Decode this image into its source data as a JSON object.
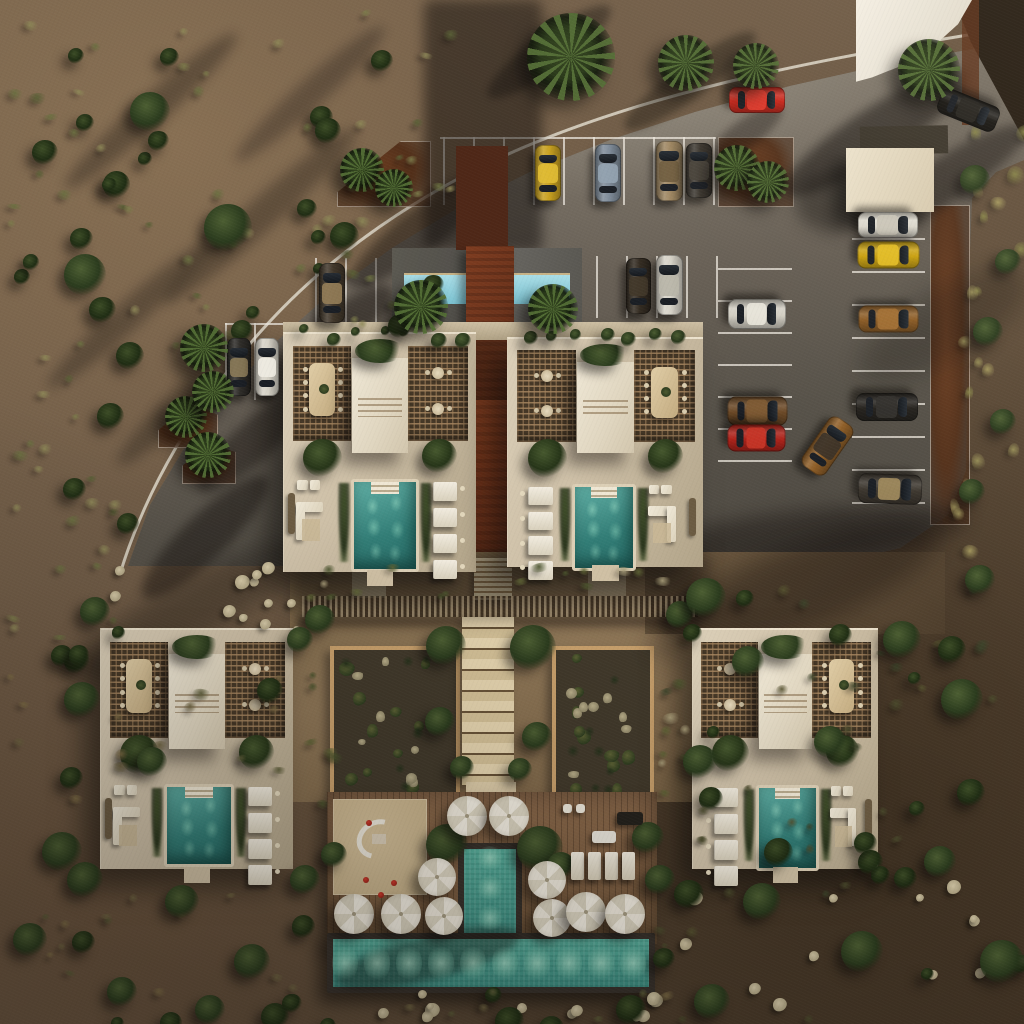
{
  "meta": {
    "type": "architectural-aerial-render",
    "description": "Top-down 3D architectural rendering of a desert resort complex: four villa units with rooftop pergolas and private teal pools, two central courtyard garden plots, a T-shaped public pool with white umbrellas and wood deck, a lap pool with rust walkway, and a curved gray parking lot with parked cars surrounded by scrub desert."
  },
  "palette": {
    "desert": "#6a5845",
    "desert_dark": "#4c3c2b",
    "road": "#7e766a",
    "road_shadow": "#4b463f",
    "building": "#cdbfa6",
    "roof_volume": "#efe7d5",
    "lattice": "#453726",
    "pool_private": "#327d76",
    "pool_main": "#3b8c80",
    "pool_lap": "#7cc3d2",
    "rust_walkway": "#6e3219",
    "wood_deck": "#7a5c40",
    "sand": "#cfbb95",
    "umbrella": "#f2ede1",
    "garden_soil": "#40382a",
    "garden_frame": "#c79f6b",
    "stairs": "#d9c7a4"
  },
  "curb_path": "M 120 574 C 146 488 196 404 262 330 C 330 254 420 192 522 148 C 640 98 780 64 1012 28",
  "stall_groups": [
    {
      "dir": "v",
      "xs": [
        443,
        473,
        503,
        533,
        563,
        593,
        623,
        653,
        683,
        713
      ],
      "y1": 137,
      "y2": 205
    },
    {
      "dir": "h",
      "ys": [
        137
      ],
      "x1": 440,
      "x2": 716
    },
    {
      "dir": "v",
      "xs": [
        315,
        345,
        375,
        405
      ],
      "y1": 258,
      "y2": 330
    },
    {
      "dir": "v",
      "xs": [
        596,
        626,
        656,
        686,
        716
      ],
      "y1": 256,
      "y2": 318
    },
    {
      "dir": "v",
      "xs": [
        225,
        254,
        283
      ],
      "y1": 323,
      "y2": 400
    },
    {
      "dir": "h",
      "ys": [
        323
      ],
      "x1": 225,
      "x2": 283
    },
    {
      "dir": "h",
      "ys": [
        268,
        300,
        332,
        364,
        396,
        428,
        460
      ],
      "x1": 718,
      "x2": 792
    },
    {
      "dir": "h",
      "ys": [
        205,
        238,
        271,
        304,
        337,
        370,
        403,
        436,
        469,
        502
      ],
      "x1": 852,
      "x2": 925
    }
  ],
  "planters": [
    {
      "x": 337,
      "y": 141,
      "w": 92,
      "h": 64,
      "clip": "polygon(0 78%, 68% 0, 100% 0, 100% 100%, 0 100%)"
    },
    {
      "x": 718,
      "y": 137,
      "w": 74,
      "h": 68,
      "clip": ""
    },
    {
      "x": 158,
      "y": 402,
      "w": 58,
      "h": 44,
      "clip": "polygon(0 62%, 55% 0, 100% 28%, 100% 100%, 0 100%)"
    },
    {
      "x": 182,
      "y": 444,
      "w": 52,
      "h": 38,
      "clip": "polygon(0 55%, 50% 0, 100% 20%, 100% 100%, 0 100%)"
    },
    {
      "x": 930,
      "y": 205,
      "w": 38,
      "h": 318,
      "clip": ""
    }
  ],
  "shadow_streaks": [
    {
      "x": 424,
      "y": 0,
      "w": 118,
      "h": 252,
      "rot": 0,
      "op": 0.5,
      "bl": 6,
      "shape": "rect",
      "layer": "road"
    },
    {
      "x": 766,
      "y": 108,
      "w": 220,
      "h": 50,
      "rot": -33,
      "op": 0.5,
      "bl": 5,
      "shape": "ell",
      "layer": "road"
    },
    {
      "x": 842,
      "y": 160,
      "w": 200,
      "h": 44,
      "rot": -33,
      "op": 0.45,
      "bl": 5,
      "shape": "ell",
      "layer": "road"
    },
    {
      "x": 474,
      "y": 34,
      "w": 150,
      "h": 36,
      "rot": -36,
      "op": 0.4,
      "bl": 4,
      "shape": "ell",
      "layer": "road"
    },
    {
      "x": 610,
      "y": 64,
      "w": 160,
      "h": 34,
      "rot": -36,
      "op": 0.38,
      "bl": 4,
      "shape": "ell",
      "layer": "road"
    },
    {
      "x": 700,
      "y": 120,
      "w": 90,
      "h": 28,
      "rot": -36,
      "op": 0.35,
      "bl": 4,
      "shape": "ell",
      "layer": "road"
    },
    {
      "x": 330,
      "y": 205,
      "w": 190,
      "h": 44,
      "rot": -38,
      "op": 0.45,
      "bl": 5,
      "shape": "ell",
      "layer": "road"
    },
    {
      "x": 240,
      "y": 320,
      "w": 170,
      "h": 44,
      "rot": -40,
      "op": 0.45,
      "bl": 5,
      "shape": "ell",
      "layer": "road"
    },
    {
      "x": 180,
      "y": 420,
      "w": 150,
      "h": 40,
      "rot": -42,
      "op": 0.42,
      "bl": 5,
      "shape": "ell",
      "layer": "road"
    },
    {
      "x": 120,
      "y": 515,
      "w": 170,
      "h": 44,
      "rot": -44,
      "op": 0.45,
      "bl": 5,
      "shape": "ell",
      "layer": "road"
    },
    {
      "x": 795,
      "y": 172,
      "w": 80,
      "h": 60,
      "rot": 0,
      "op": 0.4,
      "bl": 8,
      "shape": "ell",
      "layer": "road"
    },
    {
      "x": 640,
      "y": 510,
      "w": 330,
      "h": 52,
      "rot": -6,
      "op": 0.42,
      "bl": 9,
      "shape": "ell",
      "layer": "road"
    },
    {
      "x": 848,
      "y": 290,
      "w": 190,
      "h": 70,
      "rot": -30,
      "op": 0.26,
      "bl": 12,
      "shape": "ell",
      "layer": "road"
    },
    {
      "x": 36,
      "y": 96,
      "w": 230,
      "h": 30,
      "rot": -42,
      "op": 0.32,
      "bl": 6,
      "shape": "ell",
      "layer": "back"
    },
    {
      "x": 130,
      "y": 200,
      "w": 260,
      "h": 32,
      "rot": -42,
      "op": 0.3,
      "bl": 6,
      "shape": "ell",
      "layer": "back"
    },
    {
      "x": 20,
      "y": 300,
      "w": 220,
      "h": 28,
      "rot": -42,
      "op": 0.3,
      "bl": 6,
      "shape": "ell",
      "layer": "back"
    },
    {
      "x": 210,
      "y": 80,
      "w": 200,
      "h": 28,
      "rot": -42,
      "op": 0.28,
      "bl": 6,
      "shape": "ell",
      "layer": "back"
    },
    {
      "x": 90,
      "y": 380,
      "w": 200,
      "h": 30,
      "rot": -44,
      "op": 0.3,
      "bl": 6,
      "shape": "ell",
      "layer": "back"
    },
    {
      "x": 292,
      "y": 552,
      "w": 418,
      "h": 66,
      "rot": 0,
      "op": 0.42,
      "bl": 9,
      "shape": "rect",
      "layer": "mid"
    },
    {
      "x": 640,
      "y": 548,
      "w": 310,
      "h": 84,
      "rot": -22,
      "op": 0.36,
      "bl": 12,
      "shape": "ell",
      "layer": "mid"
    },
    {
      "x": 60,
      "y": 580,
      "w": 260,
      "h": 60,
      "rot": -30,
      "op": 0.3,
      "bl": 10,
      "shape": "ell",
      "layer": "mid"
    }
  ],
  "cars": [
    {
      "c": [
        757,
        100
      ],
      "w": 26,
      "l": 56,
      "rot": 90,
      "color": "#c8251a",
      "roof": "#e0392c"
    },
    {
      "c": [
        548,
        173
      ],
      "w": 26,
      "l": 56,
      "rot": 0,
      "color": "#c9a11f",
      "roof": "#e0bc33"
    },
    {
      "c": [
        608,
        173
      ],
      "w": 26,
      "l": 58,
      "rot": 0,
      "color": "#7e8b99",
      "roof": "#93a2b0"
    },
    {
      "c": [
        669,
        171
      ],
      "w": 27,
      "l": 60,
      "rot": 0,
      "color": "#9d8560",
      "roof": "#6e5b3e"
    },
    {
      "c": [
        699,
        170
      ],
      "w": 26,
      "l": 55,
      "rot": 0,
      "color": "#3a352e",
      "roof": "#4a443c"
    },
    {
      "c": [
        332,
        293
      ],
      "w": 26,
      "l": 60,
      "rot": 0,
      "color": "#41372a",
      "roof": "#937c57"
    },
    {
      "c": [
        638,
        286
      ],
      "w": 25,
      "l": 56,
      "rot": 0,
      "color": "#332b21",
      "roof": "#413729"
    },
    {
      "c": [
        669,
        285
      ],
      "w": 27,
      "l": 60,
      "rot": 0,
      "color": "#d7d3c8",
      "roof": "#b9b5a8"
    },
    {
      "c": [
        239,
        367
      ],
      "w": 24,
      "l": 58,
      "rot": 0,
      "color": "#2e2c28",
      "roof": "#8a7a58"
    },
    {
      "c": [
        267,
        367
      ],
      "w": 24,
      "l": 58,
      "rot": 0,
      "color": "#d6d2c6",
      "roof": "#efece2"
    },
    {
      "c": [
        757,
        314
      ],
      "w": 30,
      "l": 58,
      "rot": 90,
      "color": "#d2cec3",
      "roof": "#e8e5da"
    },
    {
      "c": [
        757,
        411
      ],
      "w": 29,
      "l": 60,
      "rot": 90,
      "color": "#6a4826",
      "roof": "#7e5a33"
    },
    {
      "c": [
        756,
        438
      ],
      "w": 27,
      "l": 58,
      "rot": 90,
      "color": "#ad231a",
      "roof": "#c53527"
    },
    {
      "c": [
        827,
        446
      ],
      "w": 29,
      "l": 60,
      "rot": 35,
      "color": "#8f5e27",
      "roof": "#3a3127"
    },
    {
      "c": [
        888,
        225
      ],
      "w": 26,
      "l": 60,
      "rot": 90,
      "color": "#dcd8cd",
      "roof": "#c9c4b7"
    },
    {
      "c": [
        888,
        255
      ],
      "w": 27,
      "l": 62,
      "rot": 90,
      "color": "#c9a00e",
      "roof": "#e3bd25"
    },
    {
      "c": [
        888,
        319
      ],
      "w": 27,
      "l": 60,
      "rot": 90,
      "color": "#8a5a24",
      "roof": "#a26f33"
    },
    {
      "c": [
        887,
        407
      ],
      "w": 28,
      "l": 62,
      "rot": 90,
      "color": "#24211d",
      "roof": "#32302c"
    },
    {
      "c": [
        890,
        489
      ],
      "w": 30,
      "l": 64,
      "rot": 92,
      "color": "#3c362e",
      "roof": "#a08a5c"
    },
    {
      "c": [
        968,
        110
      ],
      "w": 27,
      "l": 62,
      "rot": 112,
      "color": "#191714",
      "roof": "#262420"
    }
  ],
  "trees": [
    {
      "x": 571,
      "y": 57,
      "d": 88,
      "k": "palm",
      "r": 0
    },
    {
      "x": 686,
      "y": 63,
      "d": 56,
      "k": "palm",
      "r": 40
    },
    {
      "x": 756,
      "y": 66,
      "d": 46,
      "k": "palm",
      "r": 80
    },
    {
      "x": 929,
      "y": 70,
      "d": 62,
      "k": "palm",
      "r": 20
    },
    {
      "x": 737,
      "y": 168,
      "d": 46,
      "k": "palm",
      "r": 10
    },
    {
      "x": 768,
      "y": 182,
      "d": 42,
      "k": "palm",
      "r": 55
    },
    {
      "x": 362,
      "y": 170,
      "d": 44,
      "k": "palm",
      "r": 0
    },
    {
      "x": 394,
      "y": 188,
      "d": 38,
      "k": "palm",
      "r": 70
    },
    {
      "x": 186,
      "y": 417,
      "d": 42,
      "k": "palm",
      "r": 15
    },
    {
      "x": 208,
      "y": 455,
      "d": 46,
      "k": "palm",
      "r": 60
    },
    {
      "x": 204,
      "y": 348,
      "d": 48,
      "k": "palm",
      "r": 30
    },
    {
      "x": 213,
      "y": 392,
      "d": 42,
      "k": "palm",
      "r": 75
    },
    {
      "x": 421,
      "y": 307,
      "d": 54,
      "k": "palm",
      "r": 20
    },
    {
      "x": 553,
      "y": 309,
      "d": 50,
      "k": "palm",
      "r": 65
    },
    {
      "x": 228,
      "y": 228,
      "d": 48,
      "k": "bush"
    },
    {
      "x": 85,
      "y": 275,
      "d": 42,
      "k": "bush"
    },
    {
      "x": 150,
      "y": 112,
      "d": 40,
      "k": "bush"
    },
    {
      "x": 446,
      "y": 646,
      "d": 40,
      "k": "bush"
    },
    {
      "x": 533,
      "y": 648,
      "d": 46,
      "k": "bush"
    },
    {
      "x": 440,
      "y": 722,
      "d": 30,
      "k": "bush"
    },
    {
      "x": 537,
      "y": 737,
      "d": 30,
      "k": "bush"
    },
    {
      "x": 462,
      "y": 768,
      "d": 24,
      "k": "bush"
    },
    {
      "x": 520,
      "y": 770,
      "d": 24,
      "k": "bush"
    },
    {
      "x": 320,
      "y": 620,
      "d": 30,
      "k": "bush"
    },
    {
      "x": 680,
      "y": 615,
      "d": 28,
      "k": "bush"
    },
    {
      "x": 447,
      "y": 845,
      "d": 42,
      "k": "bush"
    },
    {
      "x": 540,
      "y": 849,
      "d": 46,
      "k": "bush"
    },
    {
      "x": 561,
      "y": 866,
      "d": 28,
      "k": "bush"
    },
    {
      "x": 648,
      "y": 838,
      "d": 32,
      "k": "bush"
    },
    {
      "x": 334,
      "y": 855,
      "d": 26,
      "k": "bush"
    },
    {
      "x": 660,
      "y": 880,
      "d": 30,
      "k": "bush"
    },
    {
      "x": 95,
      "y": 612,
      "d": 30,
      "k": "bush"
    },
    {
      "x": 300,
      "y": 640,
      "d": 26,
      "k": "bush"
    },
    {
      "x": 85,
      "y": 880,
      "d": 36,
      "k": "bush"
    },
    {
      "x": 305,
      "y": 880,
      "d": 30,
      "k": "bush"
    },
    {
      "x": 706,
      "y": 598,
      "d": 40,
      "k": "bush"
    },
    {
      "x": 748,
      "y": 662,
      "d": 32,
      "k": "bush"
    },
    {
      "x": 902,
      "y": 640,
      "d": 38,
      "k": "bush"
    },
    {
      "x": 962,
      "y": 700,
      "d": 42,
      "k": "bush"
    },
    {
      "x": 830,
      "y": 742,
      "d": 32,
      "k": "bush"
    },
    {
      "x": 700,
      "y": 762,
      "d": 34,
      "k": "bush"
    },
    {
      "x": 762,
      "y": 902,
      "d": 38,
      "k": "bush"
    },
    {
      "x": 862,
      "y": 952,
      "d": 42,
      "k": "bush"
    },
    {
      "x": 940,
      "y": 862,
      "d": 32,
      "k": "bush"
    },
    {
      "x": 1002,
      "y": 962,
      "d": 44,
      "k": "bush"
    },
    {
      "x": 712,
      "y": 1002,
      "d": 36,
      "k": "bush"
    },
    {
      "x": 980,
      "y": 580,
      "d": 30,
      "k": "bush"
    },
    {
      "x": 82,
      "y": 700,
      "d": 36,
      "k": "bush"
    },
    {
      "x": 152,
      "y": 762,
      "d": 30,
      "k": "bush"
    },
    {
      "x": 62,
      "y": 852,
      "d": 40,
      "k": "bush"
    },
    {
      "x": 182,
      "y": 902,
      "d": 34,
      "k": "bush"
    },
    {
      "x": 252,
      "y": 962,
      "d": 36,
      "k": "bush"
    },
    {
      "x": 122,
      "y": 992,
      "d": 30,
      "k": "bush"
    },
    {
      "x": 30,
      "y": 940,
      "d": 34,
      "k": "bush"
    },
    {
      "x": 210,
      "y": 1010,
      "d": 30,
      "k": "bush"
    },
    {
      "x": 975,
      "y": 180,
      "d": 30,
      "k": "bush"
    },
    {
      "x": 1008,
      "y": 262,
      "d": 26,
      "k": "bush"
    },
    {
      "x": 988,
      "y": 332,
      "d": 30,
      "k": "bush"
    },
    {
      "x": 1003,
      "y": 422,
      "d": 26,
      "k": "bush"
    },
    {
      "x": 972,
      "y": 492,
      "d": 26,
      "k": "bush"
    }
  ],
  "veg_zones": [
    {
      "x": 4,
      "y": 4,
      "w": 440,
      "h": 340,
      "n": 85,
      "kind": "tl"
    },
    {
      "x": 2,
      "y": 340,
      "w": 120,
      "h": 300,
      "n": 26,
      "kind": "tl"
    },
    {
      "x": 2,
      "y": 640,
      "w": 310,
      "h": 380,
      "n": 42,
      "kind": "warm"
    },
    {
      "x": 320,
      "y": 986,
      "w": 380,
      "h": 34,
      "n": 12,
      "kind": "warm"
    },
    {
      "x": 650,
      "y": 566,
      "w": 370,
      "h": 450,
      "n": 55,
      "kind": "dark"
    },
    {
      "x": 938,
      "y": 96,
      "w": 84,
      "h": 450,
      "n": 20,
      "kind": "grass"
    },
    {
      "x": 300,
      "y": 560,
      "w": 400,
      "h": 34,
      "n": 16,
      "kind": "court"
    },
    {
      "x": 300,
      "y": 640,
      "w": 28,
      "h": 160,
      "n": 6,
      "kind": "court"
    },
    {
      "x": 648,
      "y": 640,
      "w": 50,
      "h": 160,
      "n": 8,
      "kind": "court"
    }
  ],
  "stone_zones": [
    {
      "x": 332,
      "y": 988,
      "w": 330,
      "h": 28,
      "n": 12
    },
    {
      "x": 660,
      "y": 880,
      "w": 340,
      "h": 130,
      "n": 12
    },
    {
      "x": 96,
      "y": 560,
      "w": 200,
      "h": 60,
      "n": 8
    },
    {
      "x": 208,
      "y": 598,
      "w": 90,
      "h": 30,
      "n": 4
    }
  ],
  "strips": [
    {
      "x": 292,
      "y": 325,
      "w": 180,
      "h": 12,
      "n": 7
    },
    {
      "x": 515,
      "y": 325,
      "w": 180,
      "h": 12,
      "n": 7
    }
  ],
  "buildings": [
    {
      "name": "unit-upper-left",
      "x": 283,
      "y": 332,
      "w": 192,
      "h": 238,
      "flip": false,
      "pool": {
        "x": 350,
        "y": 477,
        "w": 62,
        "h": 87
      }
    },
    {
      "name": "unit-upper-right",
      "x": 507,
      "y": 337,
      "w": 195,
      "h": 228,
      "flip": true,
      "pool": {
        "x": 571,
        "y": 482,
        "w": 58,
        "h": 81
      }
    },
    {
      "name": "unit-lower-left",
      "x": 100,
      "y": 628,
      "w": 192,
      "h": 239,
      "flip": false,
      "pool": {
        "x": 163,
        "y": 782,
        "w": 64,
        "h": 77
      }
    },
    {
      "name": "unit-lower-right",
      "x": 692,
      "y": 628,
      "w": 185,
      "h": 239,
      "flip": true,
      "pool": {
        "x": 755,
        "y": 783,
        "w": 57,
        "h": 80
      }
    }
  ],
  "gardens": [
    {
      "x": 330,
      "y": 646,
      "w": 122,
      "h": 152
    },
    {
      "x": 552,
      "y": 646,
      "w": 94,
      "h": 152
    }
  ],
  "umbrellas": [
    {
      "x": 467,
      "y": 816,
      "d": 40
    },
    {
      "x": 509,
      "y": 816,
      "d": 40
    },
    {
      "x": 437,
      "y": 877,
      "d": 38
    },
    {
      "x": 444,
      "y": 916,
      "d": 38
    },
    {
      "x": 354,
      "y": 914,
      "d": 40
    },
    {
      "x": 401,
      "y": 914,
      "d": 40
    },
    {
      "x": 547,
      "y": 880,
      "d": 38
    },
    {
      "x": 552,
      "y": 918,
      "d": 38
    },
    {
      "x": 586,
      "y": 912,
      "d": 40
    },
    {
      "x": 625,
      "y": 914,
      "d": 40
    }
  ],
  "plaza": {
    "loungers": [
      {
        "x": 571,
        "y": 852
      },
      {
        "x": 588,
        "y": 852
      },
      {
        "x": 605,
        "y": 852
      },
      {
        "x": 622,
        "y": 852
      }
    ],
    "extras": [
      {
        "x": 617,
        "y": 812,
        "w": 26,
        "h": 13,
        "color": "#23201b",
        "name": "bar-counter"
      },
      {
        "x": 592,
        "y": 831,
        "w": 24,
        "h": 12,
        "color": "#e8e4da",
        "name": "cart"
      },
      {
        "x": 563,
        "y": 804,
        "w": 9,
        "h": 9,
        "color": "#ece7da",
        "name": "deck-chair"
      },
      {
        "x": 576,
        "y": 804,
        "w": 9,
        "h": 9,
        "color": "#ece7da",
        "name": "deck-chair"
      }
    ],
    "balls": [
      {
        "x": 366,
        "y": 820
      },
      {
        "x": 363,
        "y": 877
      },
      {
        "x": 391,
        "y": 880
      },
      {
        "x": 378,
        "y": 892
      }
    ],
    "basin_spots": [
      345,
      377,
      409,
      441,
      473,
      505,
      537,
      569,
      601,
      633
    ],
    "channel_spots": [
      858,
      888,
      918
    ]
  }
}
